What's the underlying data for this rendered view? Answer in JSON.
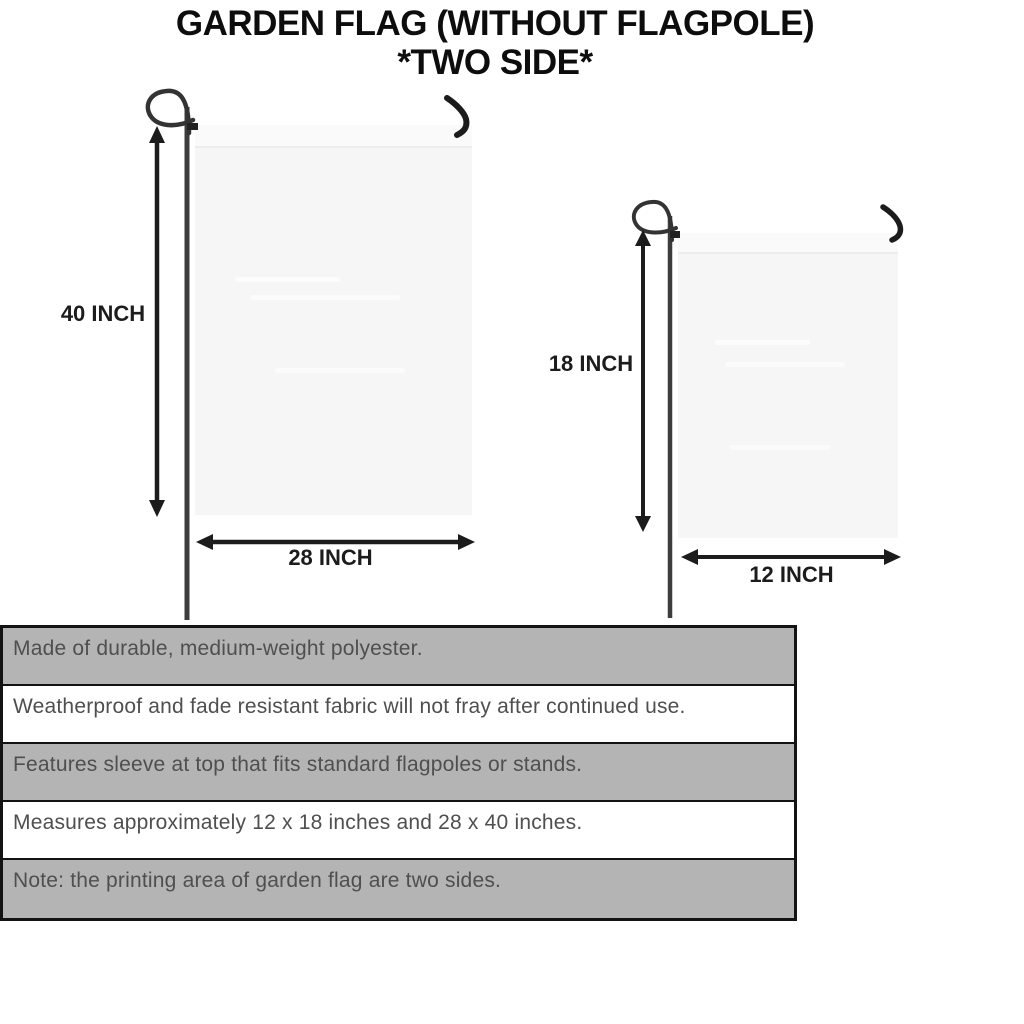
{
  "title": {
    "line1": "GARDEN FLAG (WITHOUT FLAGPOLE)",
    "line2": "*TWO SIDE*"
  },
  "flags": [
    {
      "name": "large-flag",
      "height_label": "40 INCH",
      "width_label": "28 INCH"
    },
    {
      "name": "small-flag",
      "height_label": "18 INCH",
      "width_label": "12 INCH"
    }
  ],
  "specs": {
    "rows": [
      {
        "text": "Made of durable, medium-weight polyester."
      },
      {
        "text": "Weatherproof and fade resistant fabric will not fray after continued use."
      },
      {
        "text": "Features sleeve at top that fits standard flagpoles or stands."
      },
      {
        "text": "Measures approximately 12 x 18 inches and 28 x 40 inches."
      },
      {
        "text": "Note: the printing area of garden flag are two sides."
      }
    ]
  },
  "colors": {
    "row_gray": "#b4b4b4",
    "row_white": "#ffffff",
    "table_border": "#131313",
    "spec_text": "#4f4f4f",
    "flag_fill": "#f6f6f6",
    "pole": "#3d3d3d",
    "arrow": "#1c1c1c",
    "title_text": "#0d0d0d"
  }
}
